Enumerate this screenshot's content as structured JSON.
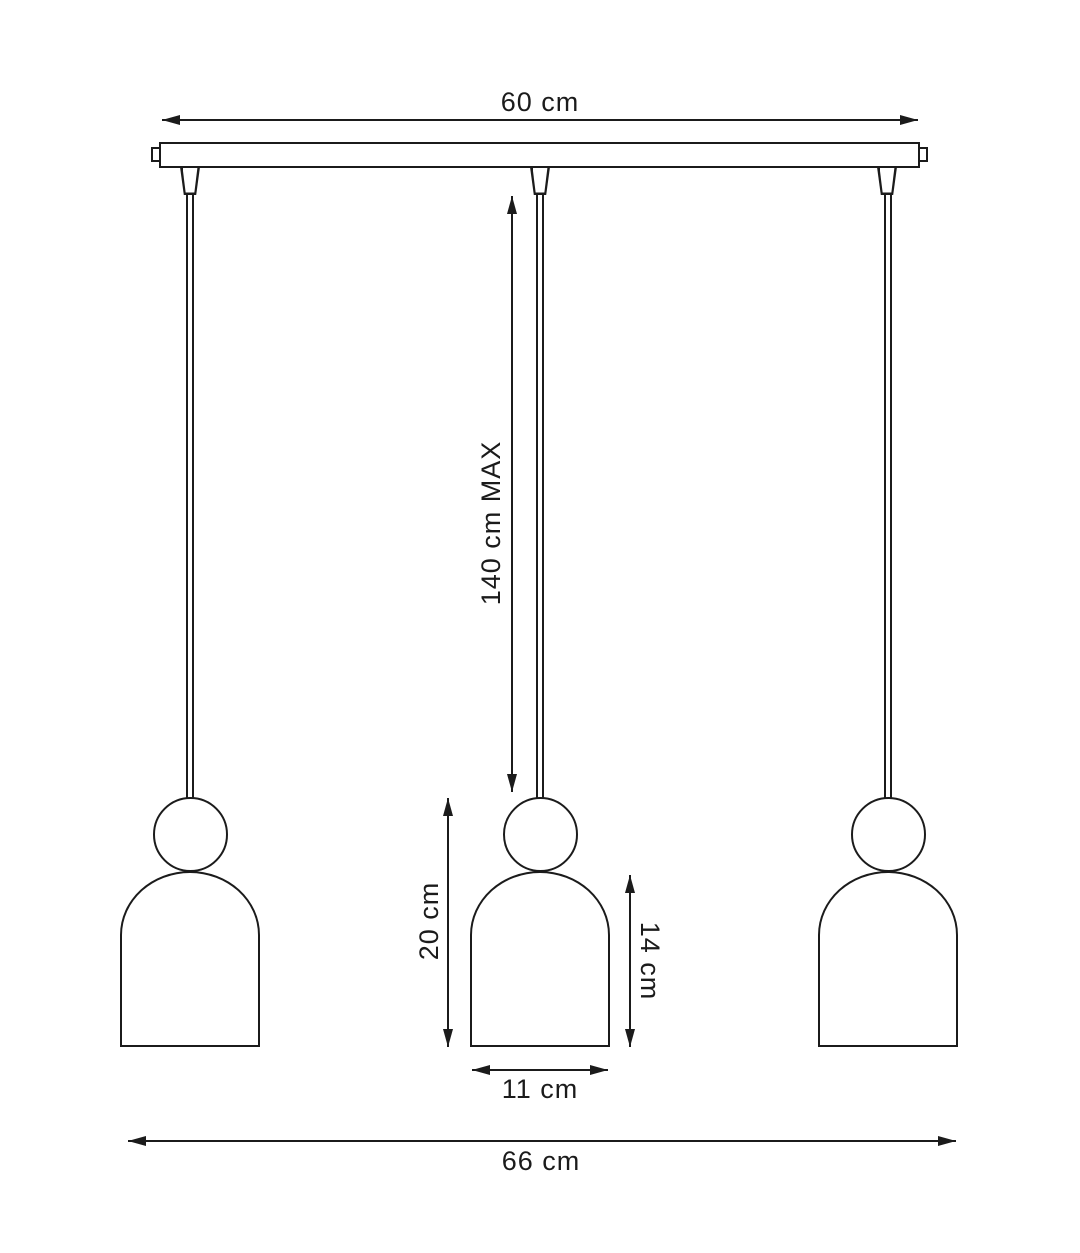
{
  "colors": {
    "line": "#1b1b1b",
    "background": "#ffffff"
  },
  "dimensions": {
    "canopy_width": {
      "label": "60 cm"
    },
    "suspension_max": {
      "label": "140 cm MAX"
    },
    "pendant_height": {
      "label": "20 cm"
    },
    "shade_height": {
      "label": "14 cm"
    },
    "shade_width": {
      "label": "11 cm"
    },
    "overall_width": {
      "label": "66 cm"
    }
  }
}
